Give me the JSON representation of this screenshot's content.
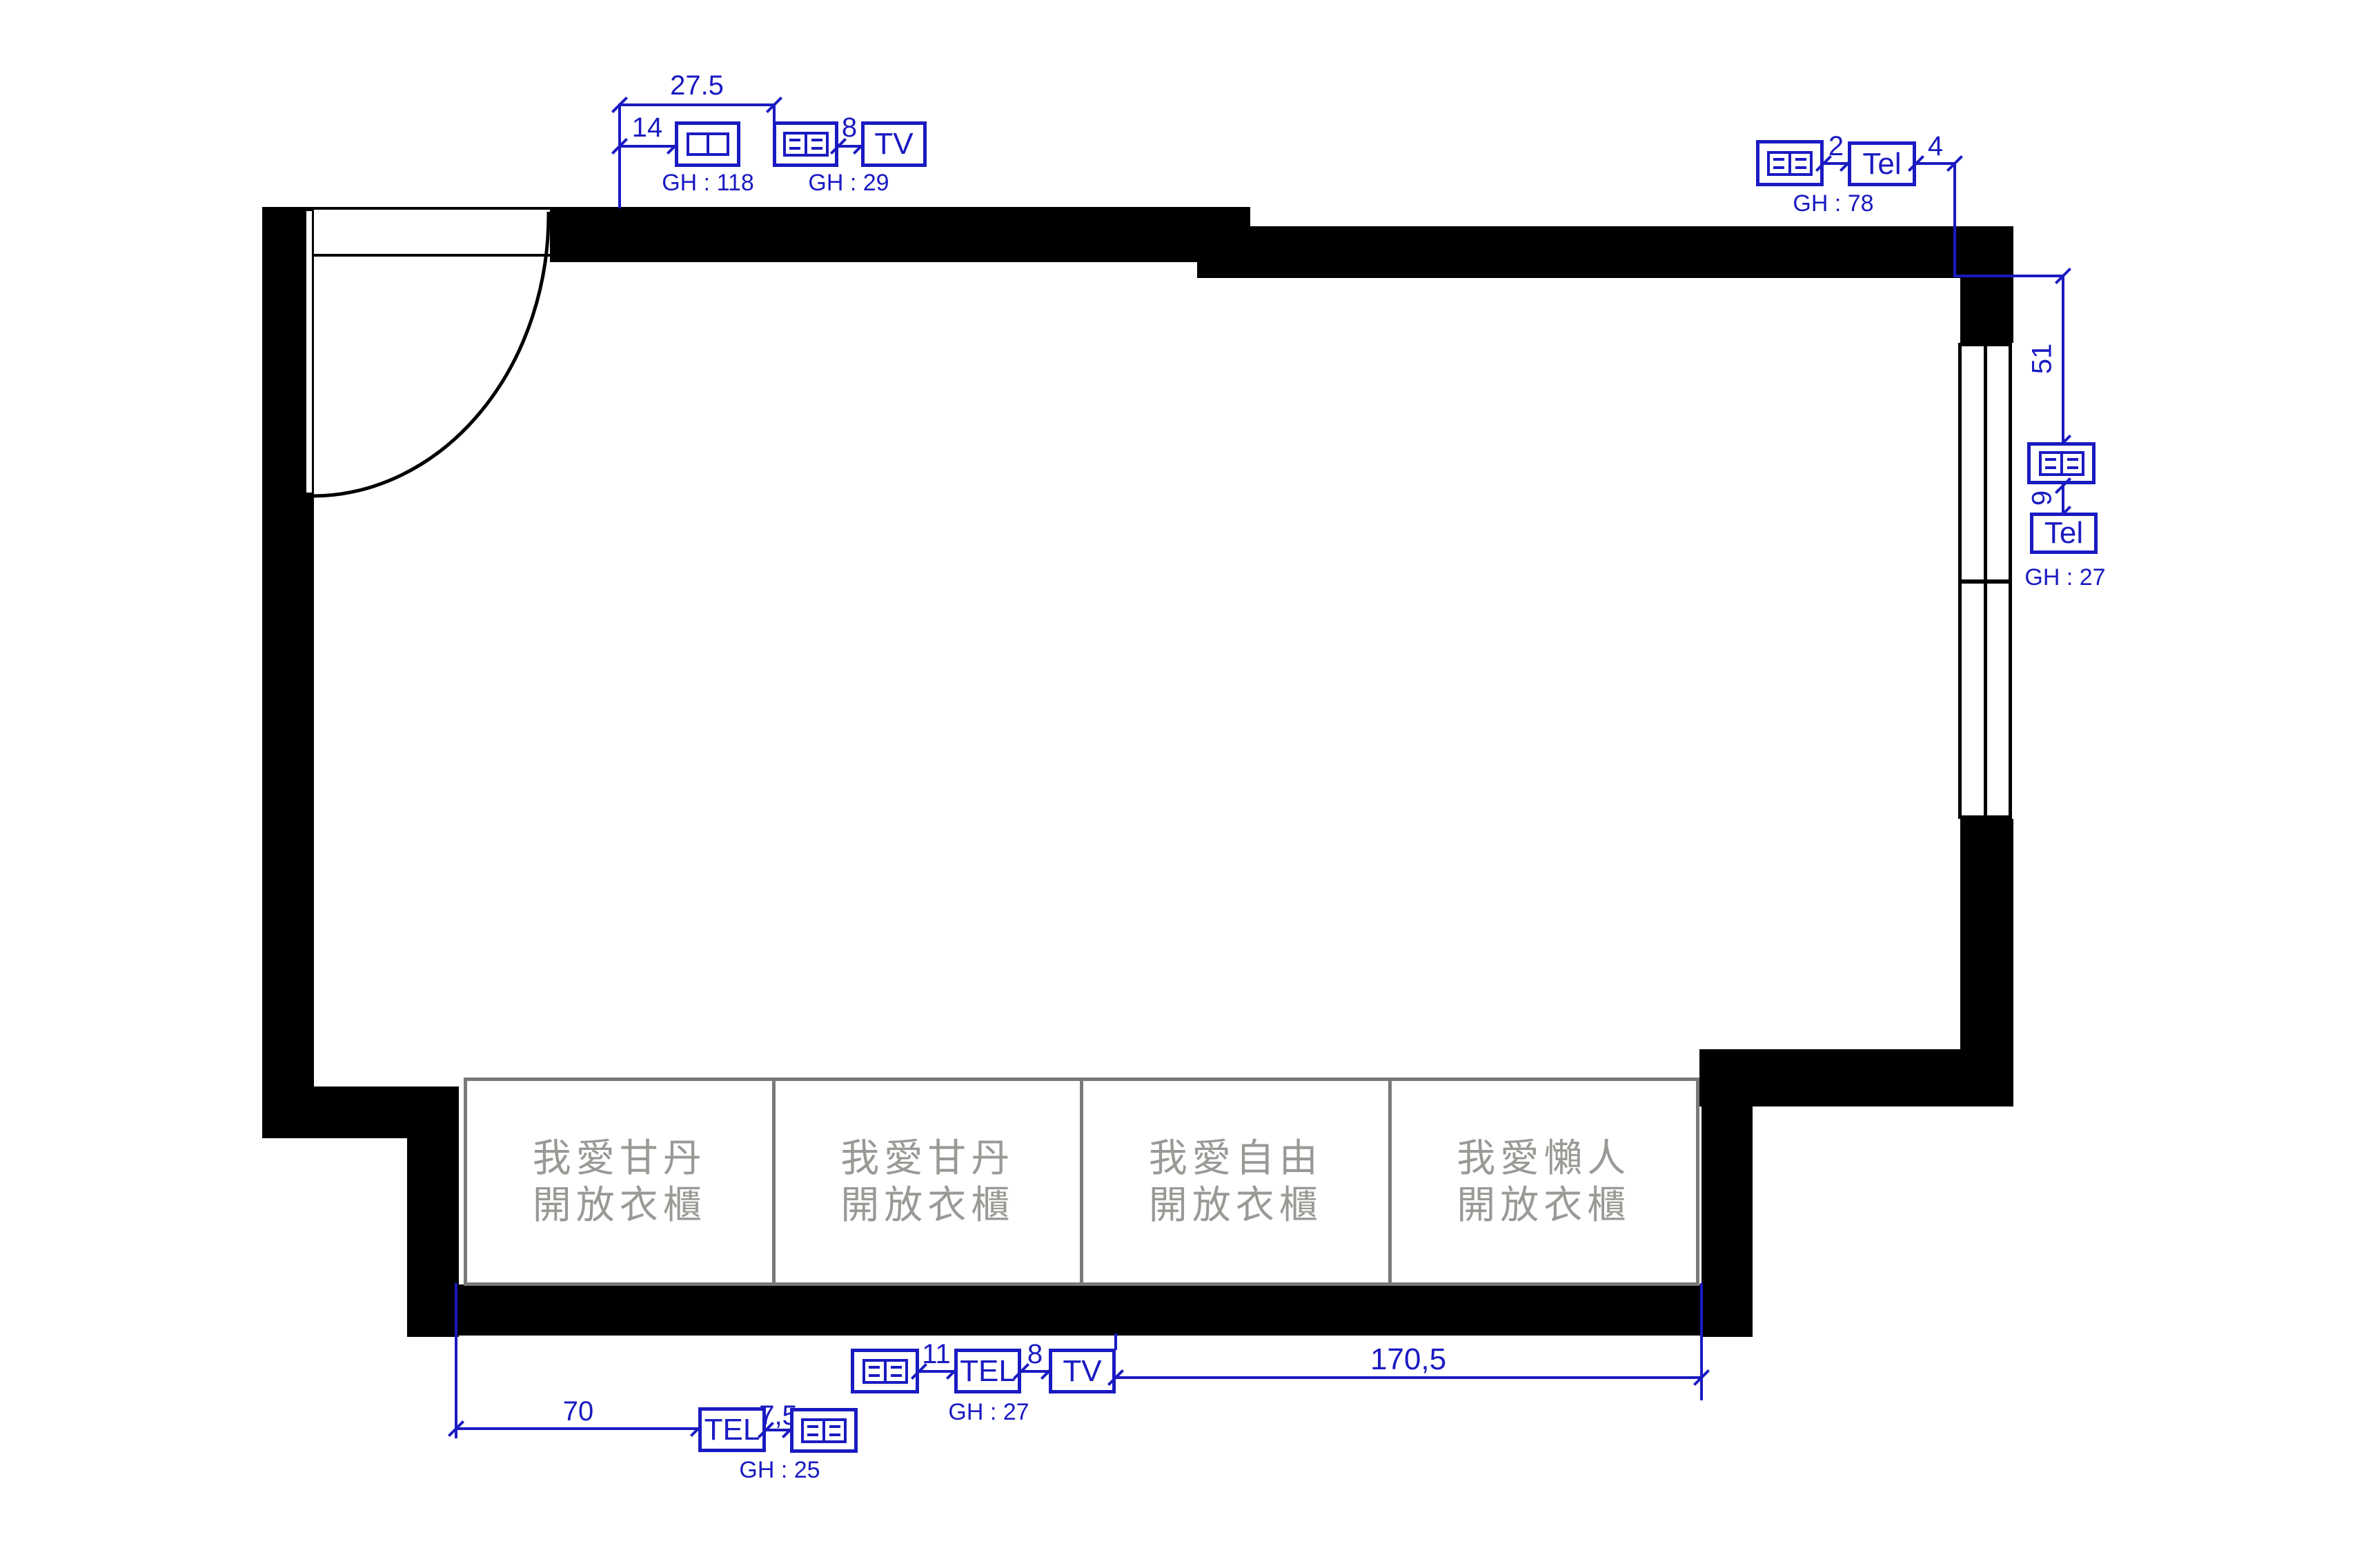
{
  "colors": {
    "blue": "#1a1ac2",
    "wall": "#000000",
    "closet_border": "#7b7976",
    "closet_text": "#9b9995"
  },
  "closets": [
    {
      "line1": "我愛甘丹",
      "line2": "開放衣櫃"
    },
    {
      "line1": "我愛甘丹",
      "line2": "開放衣櫃"
    },
    {
      "line1": "我愛自由",
      "line2": "開放衣櫃"
    },
    {
      "line1": "我愛懶人",
      "line2": "開放衣櫃"
    }
  ],
  "annotations": {
    "top_left": {
      "dim_width": "27.5",
      "dim_offset": "14",
      "dim_gap": "8",
      "tv_label": "TV",
      "gh_switch": "GH : 118",
      "gh_outlet": "GH : 29"
    },
    "top_right": {
      "dim_gap1": "2",
      "dim_gap2": "4",
      "tel_label": "Tel",
      "gh": "GH : 78"
    },
    "right": {
      "dim_down": "51",
      "dim_gap": "9",
      "tel_label": "Tel",
      "gh": "GH : 27"
    },
    "bottom_middle": {
      "dim_gap1": "11",
      "dim_gap2": "8",
      "tel_label": "TEL",
      "tv_label": "TV",
      "gh": "GH : 27",
      "dim_width": "170,5"
    },
    "bottom_left": {
      "dim_width": "70",
      "dim_gap": "7,5",
      "tel_label": "TEL",
      "gh": "GH : 25"
    }
  }
}
